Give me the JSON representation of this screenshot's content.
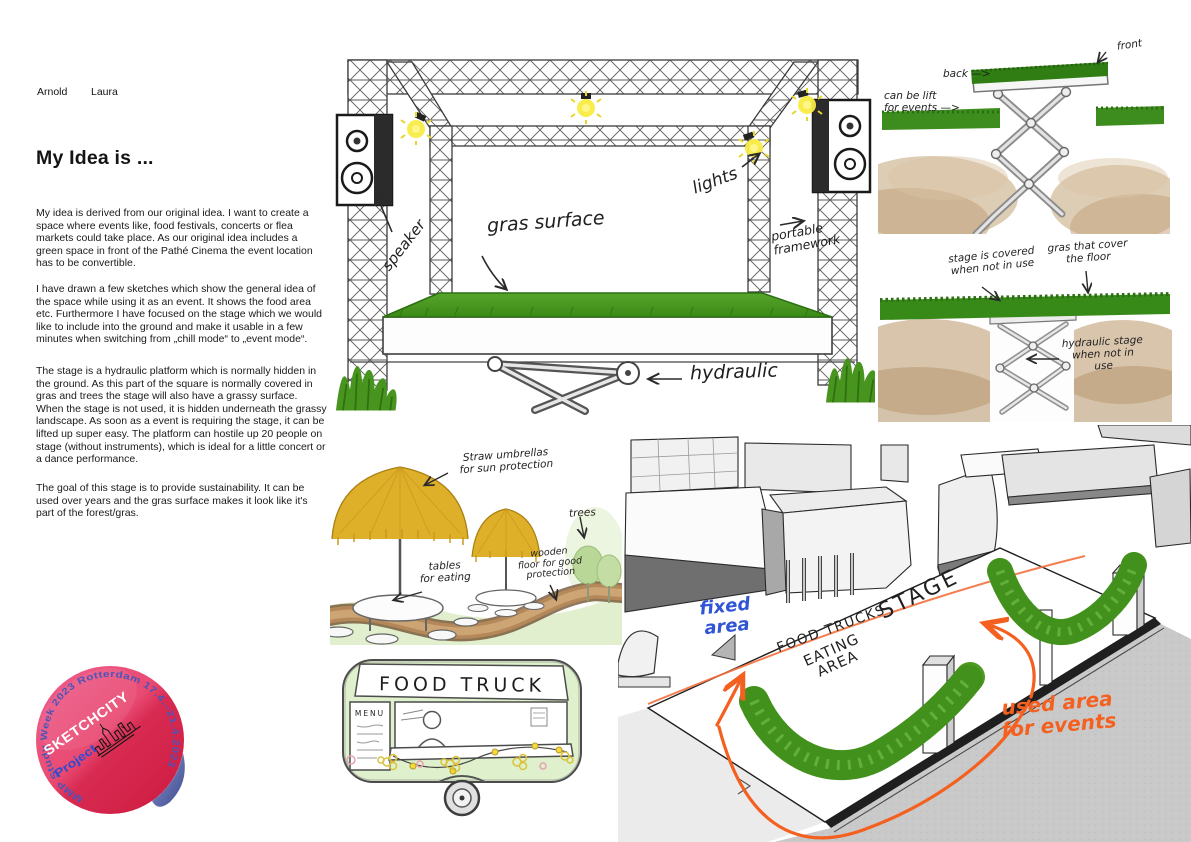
{
  "text_column": {
    "authors": [
      "Arnold",
      "Laura"
    ],
    "title": "My Idea is ...",
    "paragraphs": [
      "My idea is derived from our original idea. I want to create a space where events like, food festivals, concerts or flea markets could take place. As our original idea includes a green space in front of the Pathé Cinema the event location has to be convertible.",
      "I have drawn a few sketches which show the general idea of the space while using it as an event. It shows the food area etc. Furthermore I have focused on the stage which we would like to include into the ground and make it usable in a few minutes when switching from „chill mode“ to „event mode“.",
      "The stage is a hydraulic platform which is normally hidden in the ground. As this part of the square is normally covered in gras and trees the stage will also have a grassy surface. When the stage is not used, it is hidden underneath the grassy landscape. As soon as a event is requiring the stage, it can be lifted up super easy. The platform can hostile up 20 people on stage (without instruments), which is ideal for a little concert or a dance performance.",
      "The goal of this stage is to provide sustainability. It can be used over years and the gras surface makes it look like it's part of the forest/gras."
    ]
  },
  "stage_sketch": {
    "labels": {
      "speaker": "speaker",
      "gras_surface": "gras surface",
      "lights": "lights",
      "portable_framework": "portable\nframework",
      "hydraulic": "hydraulic"
    }
  },
  "hydraulic_up_sketch": {
    "labels": {
      "front": "front",
      "back": "back —>",
      "can_be_lift": "can be lift\nfor events —>"
    }
  },
  "hydraulic_down_sketch": {
    "labels": {
      "covered": "stage is covered\nwhen not in use",
      "gras_cover": "gras that cover\nthe floor",
      "hydraulic_stage": "hydraulic stage\nwhen not in\nuse"
    }
  },
  "food_area_sketch": {
    "labels": {
      "umbrellas": "Straw umbrellas\nfor sun protection",
      "tables": "tables\nfor eating",
      "trees": "trees",
      "wooden_floor": "wooden\nfloor for good\nprotection"
    }
  },
  "food_truck_sketch": {
    "sign": "FOOD TRUCK",
    "menu_board": "MENU"
  },
  "plaza_sketch": {
    "labels": {
      "fixed_area": "fixed\narea",
      "food_trucks": "FOOD TRUCKS",
      "stage": "STAGE",
      "eating_area": "EATING\nAREA",
      "used_area": "used area\nfor events"
    }
  },
  "badge": {
    "arc_text": "MMP Study Week 2023 Rotterdam 17.4.–21.4.2023",
    "brand": "SKETCHCITY",
    "project": "Project"
  },
  "colors": {
    "annotation_orange": "#f4601f",
    "annotation_blue": "#2f55d4",
    "grass_green": "#4d9c21",
    "straw_yellow": "#deb02a",
    "ground_brown": "#c4a67f",
    "badge_pink": "#e94a72",
    "badge_crimson": "#d01f3f",
    "badge_curl_blue": "#4d5aa6",
    "truck_green": "#dff0cc"
  }
}
